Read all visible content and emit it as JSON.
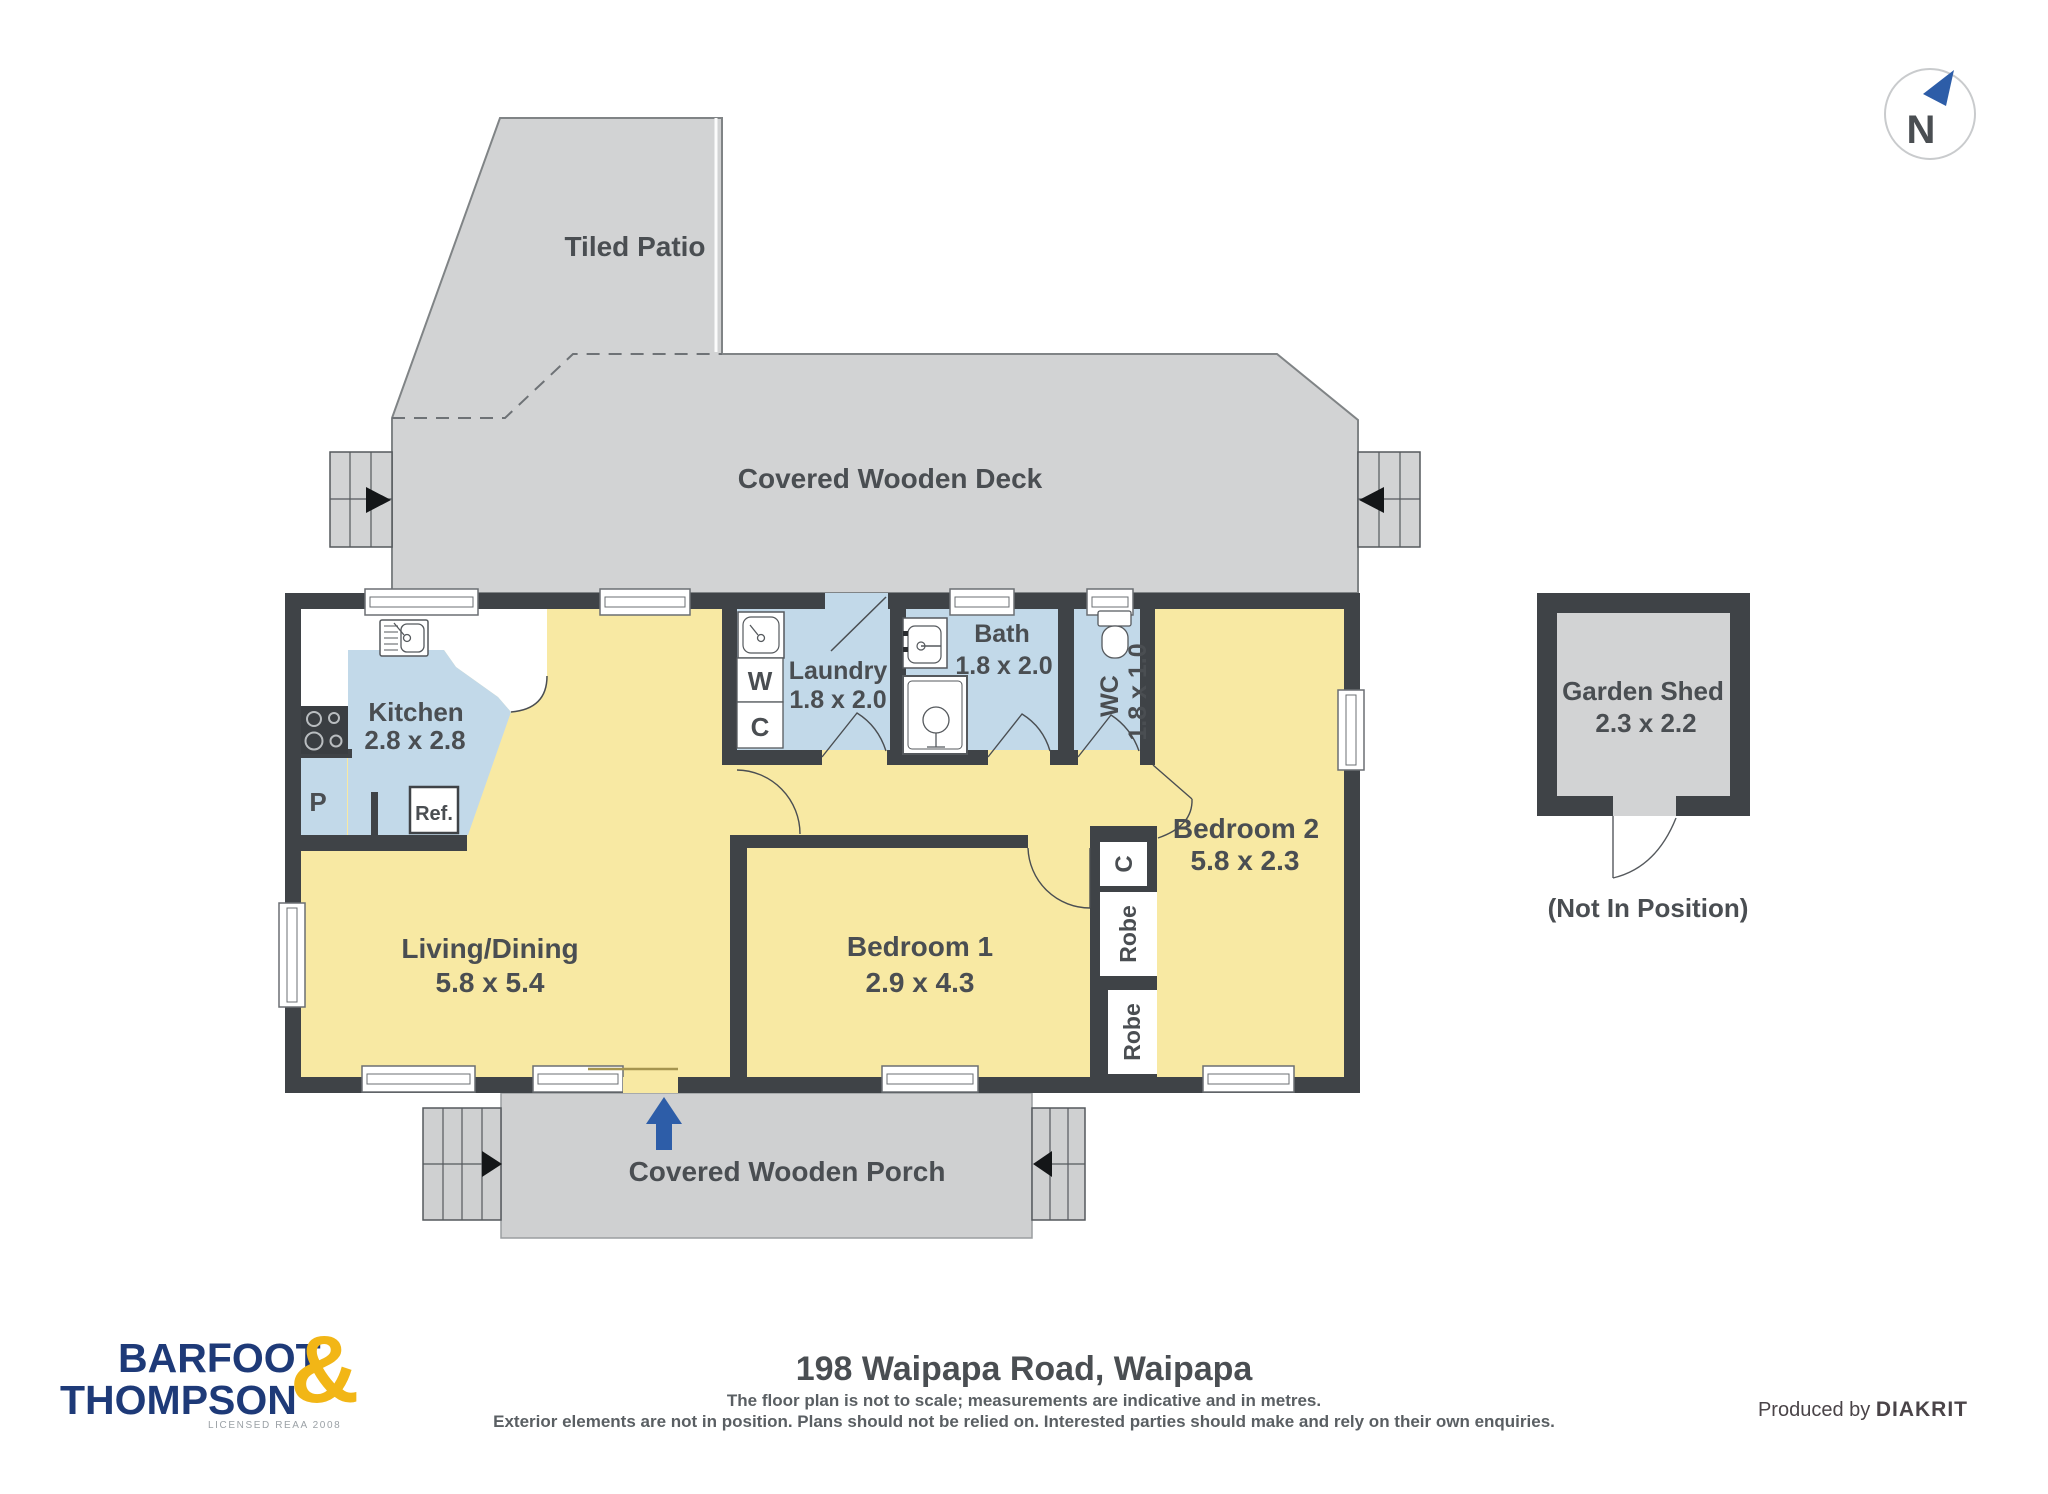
{
  "compass": {
    "label": "N"
  },
  "outdoor": {
    "patio": "Tiled Patio",
    "deck": "Covered Wooden Deck",
    "porch": "Covered Wooden Porch"
  },
  "rooms": {
    "kitchen": {
      "name": "Kitchen",
      "dims": "2.8 x 2.8"
    },
    "living": {
      "name": "Living/Dining",
      "dims": "5.8 x 5.4"
    },
    "laundry": {
      "name": "Laundry",
      "dims": "1.8 x 2.0"
    },
    "bath": {
      "name": "Bath",
      "dims": "1.8 x 2.0"
    },
    "wc": {
      "name": "WC",
      "dims": "1.8 x 1.0"
    },
    "bedroom1": {
      "name": "Bedroom 1",
      "dims": "2.9 x 4.3"
    },
    "bedroom2": {
      "name": "Bedroom 2",
      "dims": "5.8 x 2.3"
    },
    "shed": {
      "name": "Garden Shed",
      "dims": "2.3 x 2.2",
      "note": "(Not In Position)"
    }
  },
  "fixtures": {
    "pantry": "P",
    "fridge": "Ref.",
    "washer": "W",
    "laundry_cupboard": "C",
    "hall_cupboard": "C",
    "robe1": "Robe",
    "robe2": "Robe"
  },
  "footer": {
    "brand_line1": "BARFOOT",
    "brand_line2": "THOMPSON",
    "brand_amp": "&",
    "brand_sub": "LICENSED REAA 2008",
    "title": "198 Waipapa Road, Waipapa",
    "disclaimer1": "The floor plan is not to scale; measurements are indicative and in metres.",
    "disclaimer2": "Exterior elements are not in position. Plans should not be relied on. Interested parties should make and rely on their own enquiries.",
    "produced_prefix": "Produced by",
    "produced_brand": "DIAKRIT"
  },
  "colors": {
    "wall": "#3f4347",
    "floor": "#f8e9a3",
    "wet": "#c2d9e9",
    "outdoor": "#d2d3d4",
    "porch": "#cfd0d1",
    "accent": "#2d5da8",
    "brand_navy": "#1e3a78",
    "brand_yellow": "#f2b616",
    "text": "#4a4e52"
  }
}
